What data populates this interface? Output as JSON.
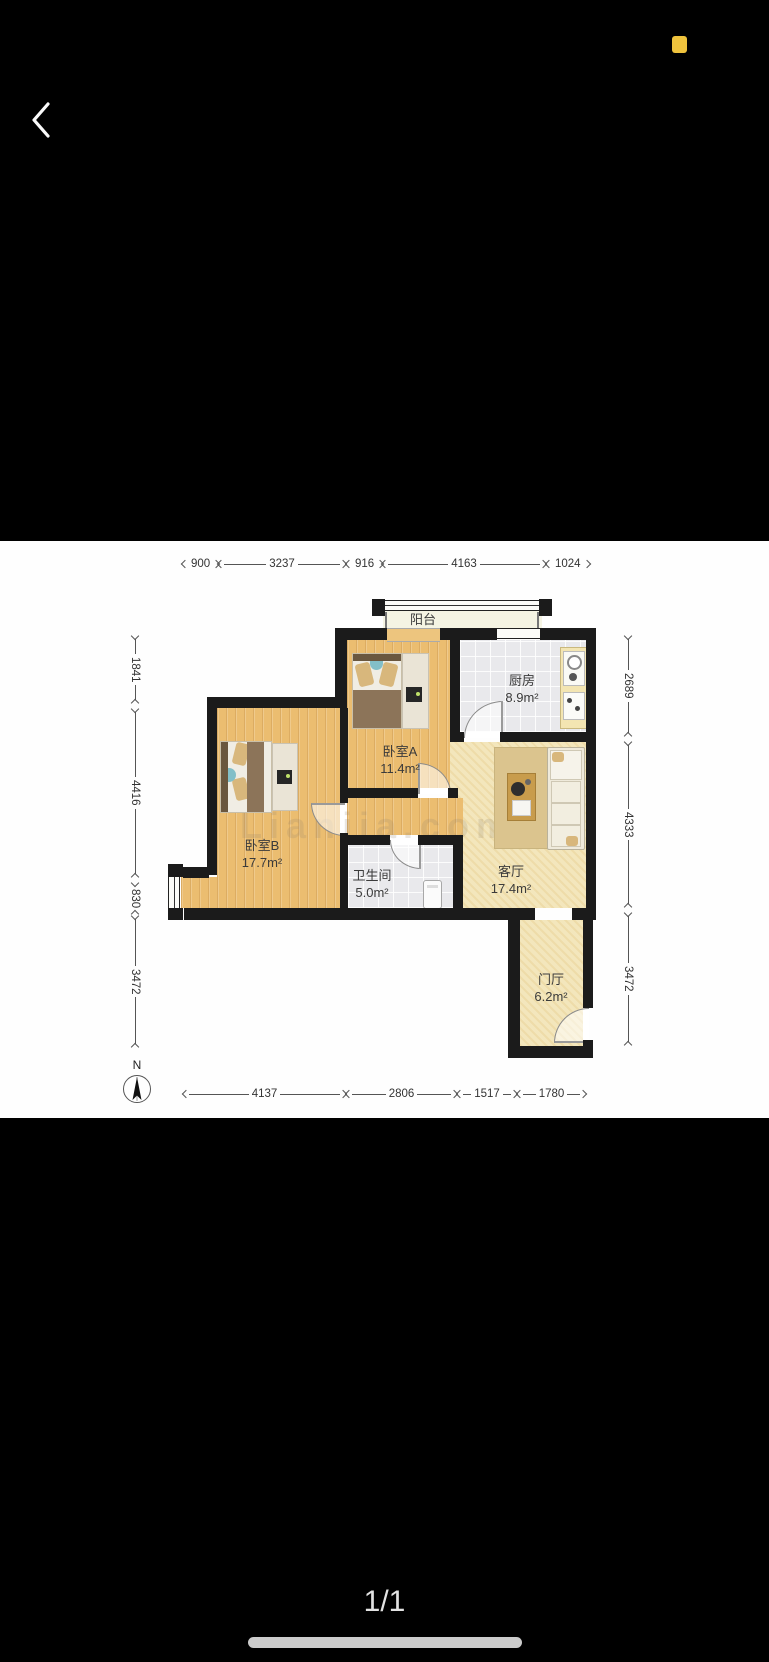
{
  "statusbar": {
    "battery_color": "#EFC33D"
  },
  "viewer": {
    "page_indicator": "1/1",
    "watermark": "Lianjia.com"
  },
  "floorplan": {
    "compass_label": "N",
    "rooms": [
      {
        "id": "balcony",
        "name": "阳台",
        "area": ""
      },
      {
        "id": "kitchen",
        "name": "厨房",
        "area": "8.9m²"
      },
      {
        "id": "bedroomA",
        "name": "卧室A",
        "area": "11.4m²"
      },
      {
        "id": "bedroomB",
        "name": "卧室B",
        "area": "17.7m²"
      },
      {
        "id": "bathroom",
        "name": "卫生间",
        "area": "5.0m²"
      },
      {
        "id": "living",
        "name": "客厅",
        "area": "17.4m²"
      },
      {
        "id": "entry",
        "name": "门厅",
        "area": "6.2m²"
      }
    ],
    "dimensions": {
      "top": [
        "900",
        "3237",
        "916",
        "4163",
        "1024"
      ],
      "left": [
        "1841",
        "4416",
        "830",
        "3472"
      ],
      "right": [
        "2689",
        "4333",
        "3472"
      ],
      "bottom": [
        "4137",
        "2806",
        "1517",
        "1780"
      ]
    },
    "colors": {
      "wall": "#1B1B1B",
      "wood_floor": "#EBBD70",
      "tile_floor": "#E9E9EC",
      "warm_floor": "#F3E6BC"
    }
  }
}
